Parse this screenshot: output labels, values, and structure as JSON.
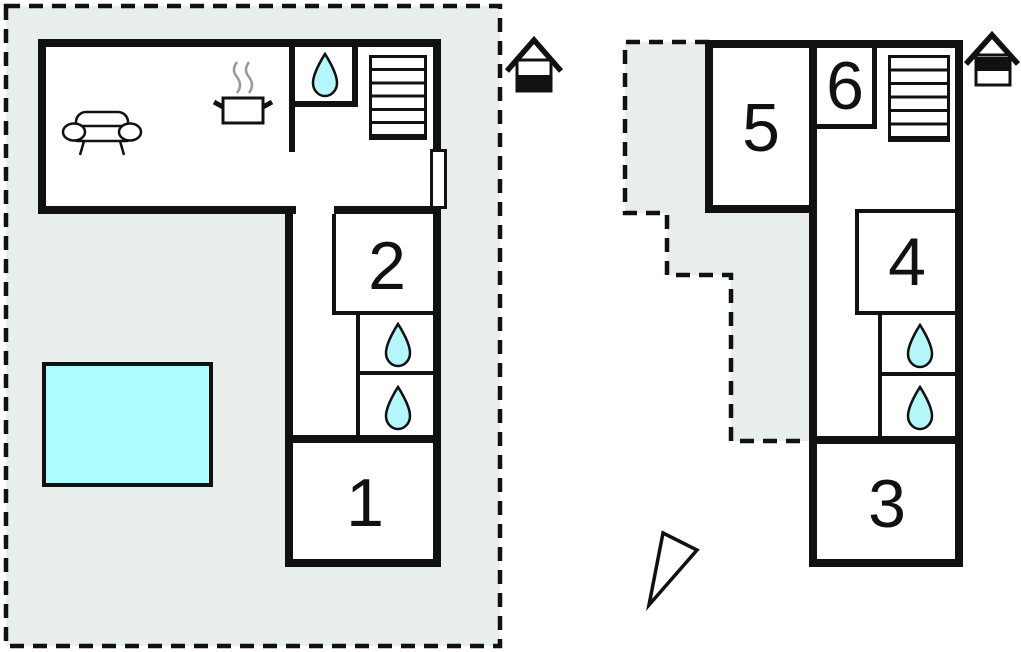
{
  "floors": {
    "ground": {
      "rooms": {
        "r1": "1",
        "r2": "2"
      },
      "icons": [
        "house-ground-floor",
        "sofa",
        "stove",
        "water-drop",
        "stairs",
        "door",
        "water-drop",
        "water-drop",
        "swimming-pool"
      ]
    },
    "upper": {
      "rooms": {
        "r3": "3",
        "r4": "4",
        "r5": "5",
        "r6": "6"
      },
      "icons": [
        "house-upper-floor",
        "stairs",
        "water-drop",
        "water-drop",
        "north-arrow"
      ]
    }
  },
  "colors": {
    "site_fill": "#e8eeec",
    "wall": "#111111",
    "water": "#b5f6fa",
    "pool": "#adfcff",
    "steam": "#999999"
  }
}
